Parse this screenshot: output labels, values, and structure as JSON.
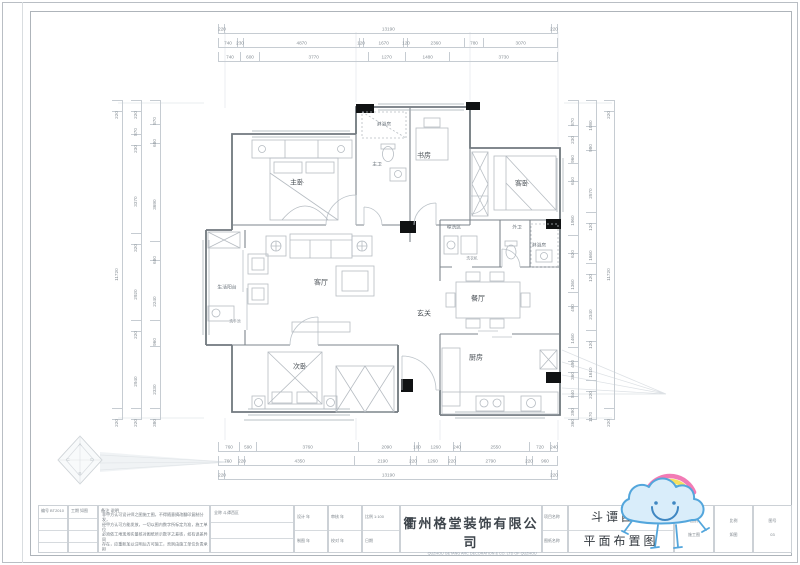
{
  "sheet": {
    "company_cn": "衢州格堂装饰有限公司",
    "company_en": "QUZHOU GETANG ARC DECORATION & CO. LTD OF QUZHOU",
    "project_name": "斗谭西区",
    "drawing_name": "平面布置图"
  },
  "title_block": {
    "col_a": [
      "编号  BT2010",
      "",
      "",
      ""
    ],
    "col_b": [
      "工期  如图",
      "",
      "",
      ""
    ],
    "notes_title": "备注  说明",
    "notes_lines": [
      "非甲方认可设计师之图施工图，不得随意摘改翻印复制分发，",
      "经甲方认可方能发放，一切以图内数字所标定为准，施工单位",
      "必须依工地现场实量核对图纸所示数字之差核，如有误差异同",
      "存在，应重新加以注明后方可施工，否则由施工单位负责承担",
      "所有责任。"
    ],
    "full_name_label": "全称  斗谭西区",
    "cells_e": [
      "设计        年",
      "制图        年"
    ],
    "cells_f": [
      "审核        年",
      "校对        年"
    ],
    "cells_g": [
      "比例  1:100",
      "日期"
    ],
    "side_labels": [
      "项目名称",
      "图纸名称"
    ],
    "cells_k": [
      "图别",
      "施工图"
    ],
    "cells_l": [
      "比例",
      "如图"
    ],
    "cells_m": [
      "图号",
      "03"
    ]
  },
  "rooms": {
    "master_bedroom": "主卧",
    "shower1": "淋浴房",
    "master_bath": "主卫",
    "study": "书房",
    "guest_bedroom": "客卧",
    "laundry": "晾洗区",
    "guest_bath": "外卫",
    "shower2": "淋浴房",
    "washer": "洗衣机",
    "dining": "餐厅",
    "foyer": "玄关",
    "living": "客厅",
    "balcony": "生活阳台",
    "washbasin": "洗手池",
    "second_bedroom": "次卧",
    "kitchen": "厨房"
  },
  "dims": {
    "top": [
      [
        "220",
        "13190",
        "220"
      ],
      [
        "740",
        "230",
        "4870",
        "120",
        "1670",
        "120",
        "2360",
        "780",
        "3070"
      ],
      [
        "740",
        "600",
        "3770",
        "1270",
        "1480",
        "3730"
      ]
    ],
    "bottom": [
      [
        "760",
        "590",
        "3760",
        "2090",
        "100",
        "1260",
        "240",
        "2550",
        "720",
        "240"
      ],
      [
        "760",
        "220",
        "4350",
        "2190",
        "220",
        "1260",
        "220",
        "2790",
        "220",
        "960"
      ],
      [
        "220",
        "13190",
        "220"
      ]
    ],
    "left": [
      [
        "220",
        "11720",
        "220"
      ],
      [
        "220",
        "870",
        "230",
        "3370",
        "320",
        "2920",
        "220",
        "2940",
        "220"
      ],
      [
        "870",
        "680",
        "3690",
        "680",
        "2240",
        "960",
        "2330",
        "380"
      ]
    ],
    "right": [
      [
        "870",
        "230",
        "960",
        "610",
        "1960",
        "620",
        "1360",
        "490",
        "1460",
        "490",
        "360",
        "840",
        "390",
        "360"
      ],
      [
        "1080",
        "980",
        "2570",
        "120",
        "1660",
        "120",
        "2340",
        "120",
        "1610",
        "220",
        "1170"
      ],
      [
        "220",
        "11720",
        "220"
      ]
    ]
  },
  "compass": {
    "letters": [
      "A",
      "D",
      "B",
      "C"
    ]
  }
}
